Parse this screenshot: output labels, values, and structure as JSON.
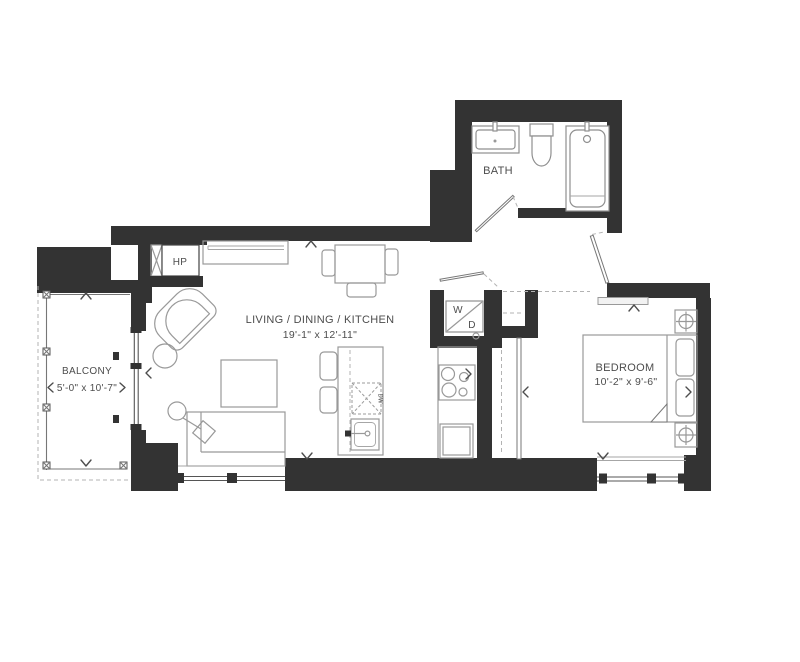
{
  "floorplan": {
    "rooms": {
      "living": {
        "label": "LIVING / DINING / KITCHEN",
        "dimensions": "19'-1\" x 12'-11\""
      },
      "balcony": {
        "label": "BALCONY",
        "dimensions": "5'-0\" x 10'-7\""
      },
      "bedroom": {
        "label": "BEDROOM",
        "dimensions": "10'-2\" x 9'-6\""
      },
      "bath": {
        "label": "BATH"
      }
    },
    "equipment": {
      "heat_pump": "HP",
      "washer": "W",
      "dryer": "D",
      "dishwasher": "DW"
    },
    "colors": {
      "wall": "#333333",
      "furniture_line": "#999999",
      "label_text": "#4d4d4d",
      "background": "#ffffff"
    }
  }
}
